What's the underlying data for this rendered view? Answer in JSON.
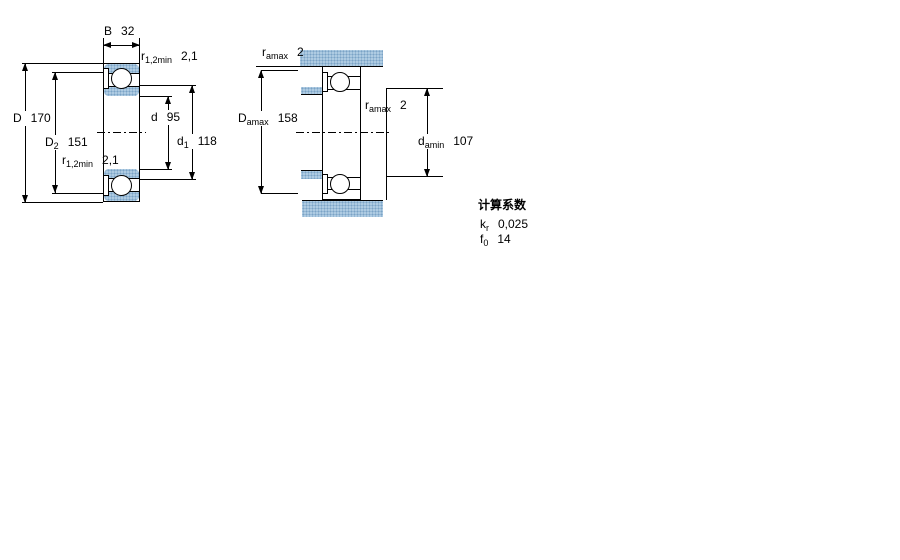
{
  "figure": {
    "left": {
      "dims": {
        "B": {
          "sym": "B",
          "sub": "",
          "val": "32"
        },
        "r12_top": {
          "sym": "r",
          "sub": "1,2min",
          "val": "2,1"
        },
        "D": {
          "sym": "D",
          "sub": "",
          "val": "170"
        },
        "D2": {
          "sym": "D",
          "sub": "2",
          "val": "151"
        },
        "r12_bot": {
          "sym": "r",
          "sub": "1,2min",
          "val": "2,1"
        },
        "d": {
          "sym": "d",
          "sub": "",
          "val": "95"
        },
        "d1": {
          "sym": "d",
          "sub": "1",
          "val": "118"
        }
      }
    },
    "right": {
      "dims": {
        "ra_top": {
          "sym": "r",
          "sub": "amax",
          "val": "2"
        },
        "Damax": {
          "sym": "D",
          "sub": "amax",
          "val": "158"
        },
        "ra_mid": {
          "sym": "r",
          "sub": "amax",
          "val": "2"
        },
        "damin": {
          "sym": "d",
          "sub": "amin",
          "val": "107"
        }
      }
    }
  },
  "calc": {
    "title": "计算系数",
    "factors": [
      {
        "sym": "k",
        "sub": "r",
        "val": "0,025"
      },
      {
        "sym": "f",
        "sub": "0",
        "val": "14"
      }
    ]
  },
  "colors": {
    "steel_blue": "#aecbe2",
    "steel_blue_dot": "#7ba3c6",
    "line": "#000000",
    "background": "#ffffff"
  }
}
